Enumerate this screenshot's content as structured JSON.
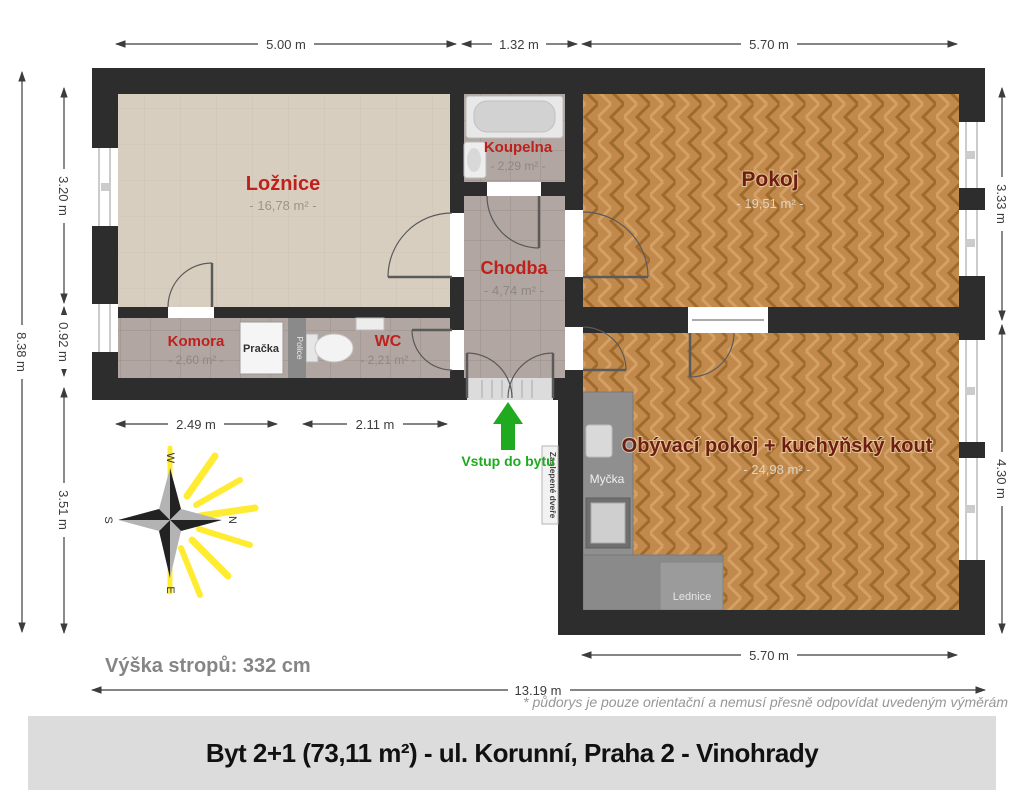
{
  "title_bar": {
    "text": "Byt 2+1 (73,11 m²) - ul. Korunní, Praha 2 - Vinohrady"
  },
  "notes": {
    "disclaimer": "* půdorys je pouze orientační a nemusí přesně odpovídat uvedeným výměrám",
    "ceiling_height": "Výška stropů: 332 cm"
  },
  "entry": {
    "label": "Vstup do bytu"
  },
  "rooms": [
    {
      "name": "Ložnice",
      "area": "- 16,78 m² -"
    },
    {
      "name": "Koupelna",
      "area": "- 2,29 m² -"
    },
    {
      "name": "Pokoj",
      "area": "- 19,51 m² -"
    },
    {
      "name": "Chodba",
      "area": "- 4,74 m² -"
    },
    {
      "name": "Komora",
      "area": "- 2,60 m² -"
    },
    {
      "name": "WC",
      "area": "- 2,21 m² -"
    },
    {
      "name": "Obývací pokoj + kuchyňský kout",
      "area": "- 24,98 m² -"
    }
  ],
  "fixtures": {
    "washer": "Pračka",
    "shelf": "Police",
    "dishwasher": "Myčka",
    "fridge": "Lednice",
    "blinded_door": "Zaslepené dveře"
  },
  "dimensions": {
    "top": [
      "5.00 m",
      "1.32 m",
      "5.70 m"
    ],
    "left_total": "8.38 m",
    "left": [
      "3.20 m",
      "0.92 m",
      "3.51 m"
    ],
    "right": [
      "3.33 m",
      "4.30 m"
    ],
    "bottom_inner": [
      "2.49 m",
      "2.11 m"
    ],
    "bottom_right": "5.70 m",
    "bottom_total": "13.19 m"
  },
  "compass": {
    "north": "N",
    "south": "S",
    "east": "E",
    "west": "W"
  },
  "colors": {
    "wall": "#2d2d2d",
    "room_label_red": "#c0201c",
    "room_label_maroon": "#6d1d12",
    "entry_green": "#1faa1f",
    "wood_floor": "#c18a4c",
    "tile_floor": "#b1a6a2",
    "bedroom_floor": "#d8cec0",
    "sun_yellow": "#ffe800"
  }
}
